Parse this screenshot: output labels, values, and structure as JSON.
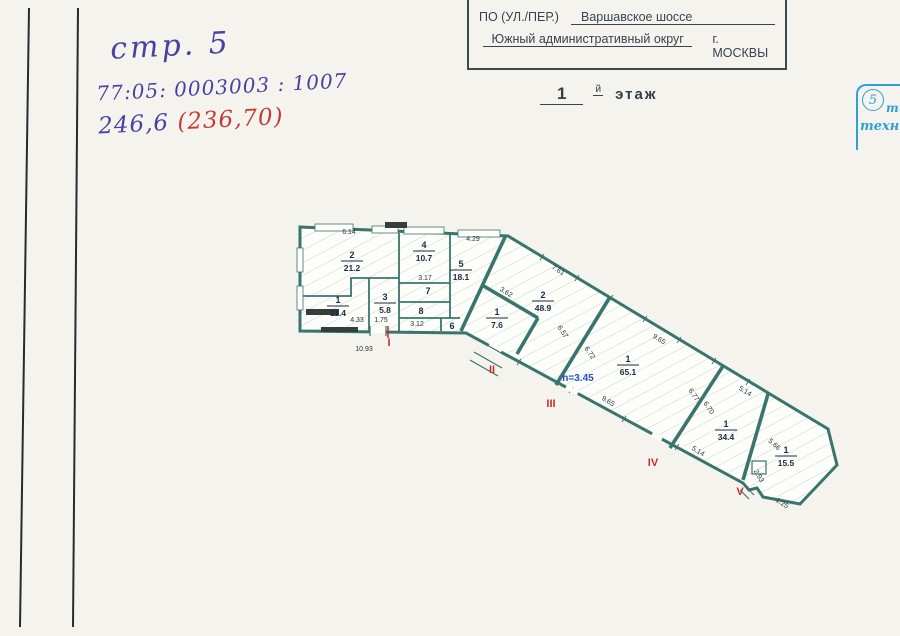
{
  "handwriting": {
    "line1": "стр. 5",
    "line2": "77:05: 0003003 : 1007",
    "line3_blue": "246,6",
    "line3_red": "(236,70)"
  },
  "header_form": {
    "row1": {
      "label_left": "КОРП. (СТР.) №",
      "label_mid": "ДОМ №",
      "value": "36"
    },
    "row2": {
      "label": "ПО (УЛ./ПЕР.)",
      "value": "Варшавское шоссе"
    },
    "row3": {
      "value_left": "Южный административный округ",
      "value_right": "г. МОСКВЫ"
    }
  },
  "floor_title": {
    "number": "1",
    "suffix": "й",
    "word": "этаж"
  },
  "stamp": {
    "number": "5",
    "line1": "ти",
    "line2": "техн",
    "color": "#2f9fd6"
  },
  "colors": {
    "paper": "#f5f3ee",
    "wall": "#3a756d",
    "hatch": "#c3d8cf",
    "room_text": "#1d2b45",
    "section_red": "#c62f28",
    "height_blue": "#1f4fc2",
    "ink_blue": "#4b3fa0",
    "ink_red": "#c43a35",
    "stamp_blue": "#2f9fd6"
  },
  "plan": {
    "height_note": {
      "text": "h=3.45"
    },
    "rooms": [
      {
        "num": "2",
        "area": "21.2",
        "x": 352,
        "y": 258
      },
      {
        "num": "4",
        "area": "10.7",
        "x": 424,
        "y": 248
      },
      {
        "num": "5",
        "area": "18.1",
        "x": 461,
        "y": 267
      },
      {
        "num": "1",
        "area": "11.4",
        "x": 338,
        "y": 303
      },
      {
        "num": "3",
        "area": "5.8",
        "x": 385,
        "y": 300
      },
      {
        "num": "7",
        "x": 428,
        "y": 294
      },
      {
        "num": "8",
        "x": 421,
        "y": 314
      },
      {
        "num": "6",
        "x": 452,
        "y": 329
      },
      {
        "num": "2",
        "area": "48.9",
        "x": 543,
        "y": 298
      },
      {
        "num": "1",
        "area": "7.6",
        "x": 497,
        "y": 315
      },
      {
        "num": "1",
        "area": "65.1",
        "x": 628,
        "y": 362
      },
      {
        "num": "1",
        "area": "34.4",
        "x": 726,
        "y": 427
      },
      {
        "num": "1",
        "area": "15.5",
        "x": 786,
        "y": 453
      }
    ],
    "dims": [
      {
        "t": "6.14",
        "x": 349,
        "y": 234,
        "r": 0
      },
      {
        "t": "4.29",
        "x": 473,
        "y": 241,
        "r": 0
      },
      {
        "t": "3.17",
        "x": 425,
        "y": 280,
        "r": 0
      },
      {
        "t": "3.12",
        "x": 417,
        "y": 326,
        "r": 0
      },
      {
        "t": "4.33",
        "x": 357,
        "y": 322,
        "r": 0
      },
      {
        "t": "1.75",
        "x": 381,
        "y": 322,
        "r": 0
      },
      {
        "t": "10.93",
        "x": 364,
        "y": 351,
        "r": 0
      },
      {
        "t": "7.61",
        "x": 557,
        "y": 272,
        "r": 32
      },
      {
        "t": "3.62",
        "x": 505,
        "y": 294,
        "r": 32
      },
      {
        "t": "6.57",
        "x": 561,
        "y": 333,
        "r": 56
      },
      {
        "t": "6.72",
        "x": 588,
        "y": 354,
        "r": 56
      },
      {
        "t": "9.65",
        "x": 658,
        "y": 341,
        "r": 32
      },
      {
        "t": "9.65",
        "x": 607,
        "y": 403,
        "r": 32
      },
      {
        "t": "6.77",
        "x": 692,
        "y": 396,
        "r": 56
      },
      {
        "t": "6.70",
        "x": 707,
        "y": 409,
        "r": 56
      },
      {
        "t": "5.14",
        "x": 744,
        "y": 393,
        "r": 32
      },
      {
        "t": "5.14",
        "x": 697,
        "y": 453,
        "r": 32
      },
      {
        "t": "5.66",
        "x": 773,
        "y": 446,
        "r": 42
      },
      {
        "t": "2.93",
        "x": 757,
        "y": 477,
        "r": 60
      },
      {
        "t": "1.25",
        "x": 781,
        "y": 505,
        "r": 32
      }
    ],
    "sections": [
      {
        "t": "I",
        "x": 389,
        "y": 346
      },
      {
        "t": "II",
        "x": 492,
        "y": 373
      },
      {
        "t": "III",
        "x": 551,
        "y": 407
      },
      {
        "t": "IV",
        "x": 653,
        "y": 466
      },
      {
        "t": "V",
        "x": 740,
        "y": 495
      }
    ]
  }
}
